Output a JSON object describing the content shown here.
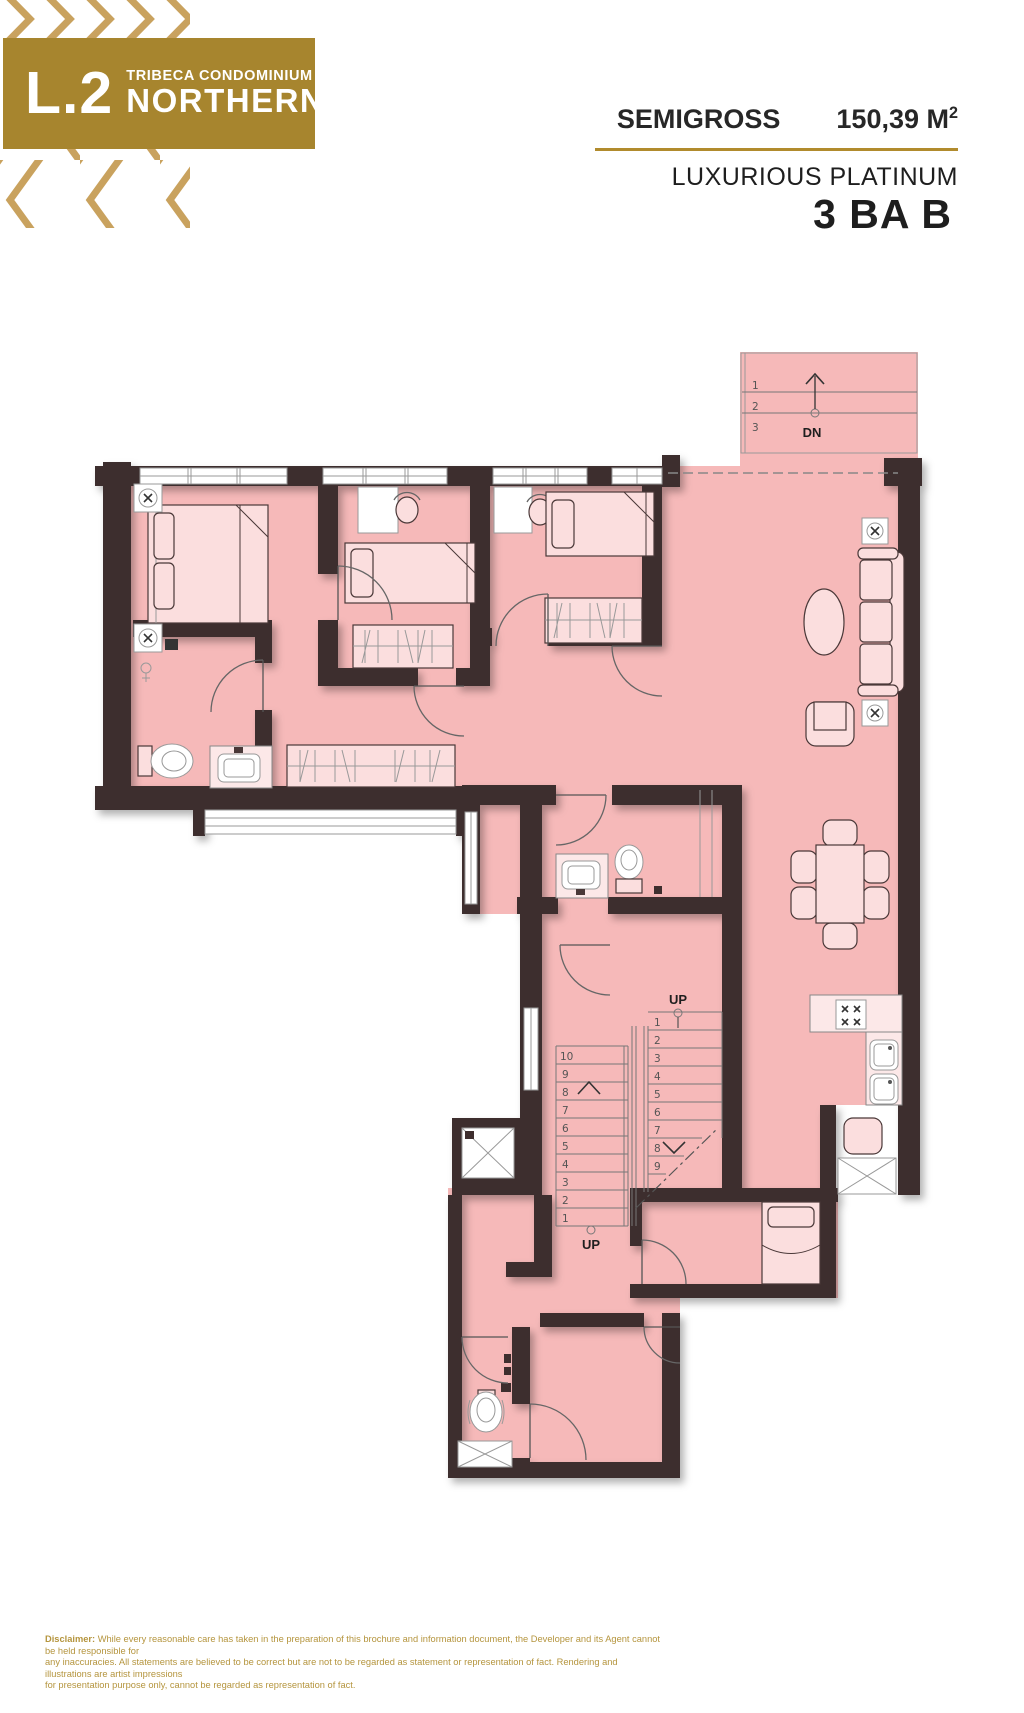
{
  "header": {
    "badge": {
      "level": "L.2",
      "project": "TRIBECA CONDOMINIUM",
      "tower": "NORTHERN"
    },
    "area": {
      "label": "SEMIGROSS",
      "value": "150,39 M",
      "sup": "2"
    },
    "collection": "LUXURIOUS PLATINUM",
    "unit": "3 BA B",
    "colors": {
      "badge_gold": "#a7852e",
      "line_gold": "#b18b2d",
      "pattern_tan": "#c9a25e"
    }
  },
  "plan": {
    "labels": {
      "down": "DN",
      "up_main": "UP",
      "up_lower": "UP"
    },
    "entry_steps": [
      "1",
      "2",
      "3"
    ],
    "flight_main_steps": [
      "1",
      "2",
      "3",
      "4",
      "5",
      "6",
      "7",
      "8",
      "9"
    ],
    "flight_lower_steps": [
      "10",
      "9",
      "8",
      "7",
      "6",
      "5",
      "4",
      "3",
      "2",
      "1"
    ],
    "colors": {
      "floor": "#f6b9b9",
      "wall": "#3e2e2e",
      "furniture": "#fbdede"
    }
  },
  "disclaimer": {
    "intro": "Disclaimer:",
    "line1_rest": " While every reasonable care has taken in the preparation of this brochure and information document, the Developer and its Agent cannot be held responsible for",
    "line2": "any inaccuracies. All statements are believed to be  correct but are not to be regarded as statement or representation of fact. Rendering and illustrations are artist impressions",
    "line3": "for presentation purpose only, cannot be regarded as representation of fact."
  }
}
